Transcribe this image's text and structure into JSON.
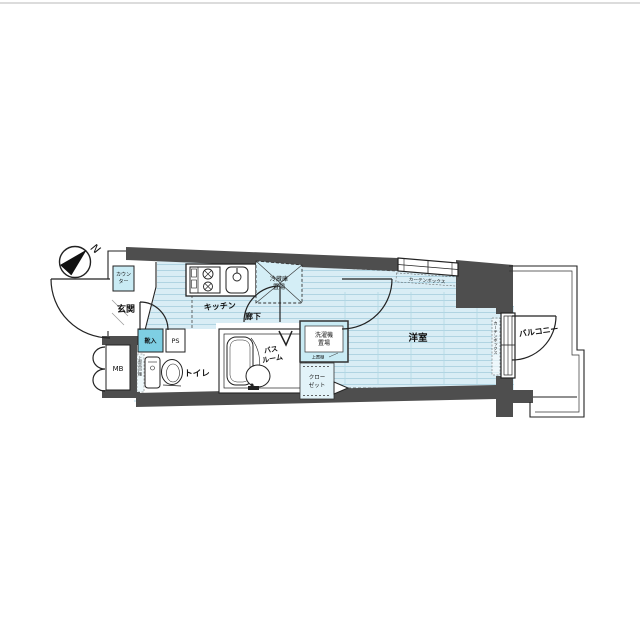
{
  "page": {
    "background": "#ffffff",
    "top_rule_color": "#dcdcdc"
  },
  "colors": {
    "wall": "#4e4e4e",
    "floor_base": "#d9edf5",
    "floor_stripe": "#abd2e0",
    "cabinet_blue": "#7ecfe3",
    "cabinet_light_blue": "#c9ebf4",
    "outline": "#222222"
  },
  "compass": {
    "north_label": "N"
  },
  "rooms": {
    "entrance": "玄関",
    "kitchen": "キッチン",
    "corridor": "廊下",
    "toilet": "トイレ",
    "bathroom_line1": "バス",
    "bathroom_line2": "ルーム",
    "western_room": "洋室",
    "balcony": "バルコニー"
  },
  "labels": {
    "counter_line1": "カウン",
    "counter_line2": "ター",
    "shoe_cabinet": "靴入",
    "pipe_space": "PS",
    "meter_box": "MB",
    "refrigerator_line1": "冷蔵庫",
    "refrigerator_line2": "置場",
    "washer_line1": "洗濯機",
    "washer_line2": "置場",
    "washer_shelf": "上置棚",
    "closet_line1": "クロー",
    "closet_line2": "ゼット",
    "toilet_shelf": "上部吊戸棚",
    "curtain_box_top": "カーテンボックス",
    "curtain_box_side": "カーテンボックス"
  }
}
